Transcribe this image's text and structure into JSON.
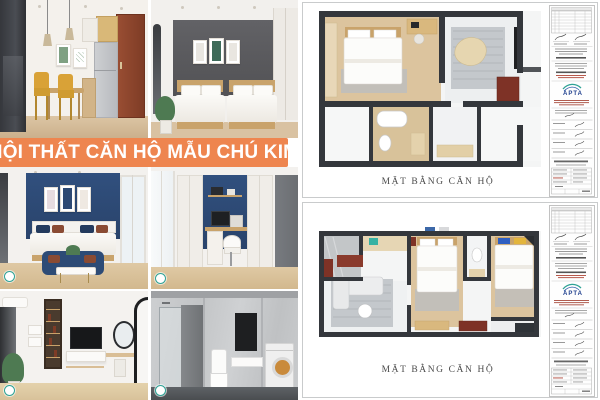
{
  "banner": {
    "label": "NỘI THẤT CĂN HỘ MẪU CHÚ KIM"
  },
  "collage": {
    "tiles": [
      {
        "scene": "dining-kitchen-render"
      },
      {
        "scene": "twin-bedroom-gray-render"
      },
      {
        "scene": "navy-bedroom-sofa-render"
      },
      {
        "scene": "study-nook-navy-render"
      },
      {
        "scene": "tv-wall-vanity-render"
      },
      {
        "scene": "bathroom-laundry-render"
      }
    ]
  },
  "sheets": [
    {
      "label": "MẶT BẰNG CĂN HỘ",
      "logo_text": "APTA"
    },
    {
      "label": "MẶT BẰNG CĂN HỘ",
      "logo_text": "APTA"
    }
  ],
  "colors": {
    "banner_bg": "#EE854F",
    "accent_navy": "#2E4A74",
    "accent_slate": "#58595B",
    "plan_wall": "#34373C",
    "plan_wood": "#DCC49E",
    "logo_teal": "#2FA396",
    "logo_blue": "#22418F",
    "red_cabinet": "#7E3226"
  }
}
